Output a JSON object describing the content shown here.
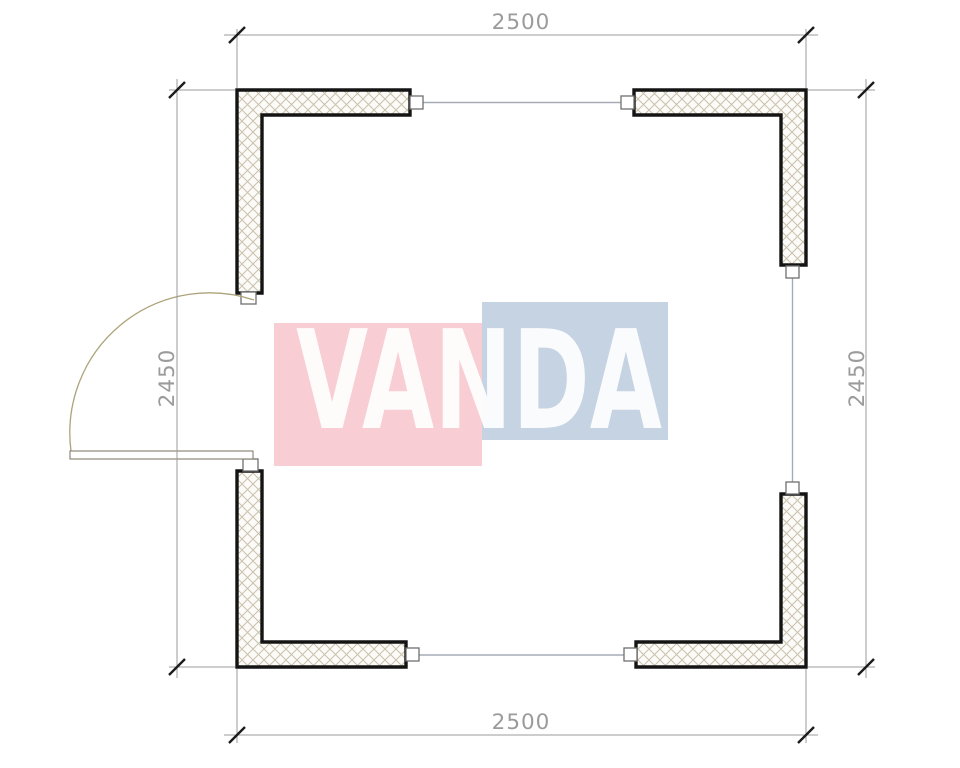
{
  "drawing": {
    "type": "floor-plan",
    "dimensions": {
      "top": "2500",
      "bottom": "2500",
      "left": "2450",
      "right": "2450"
    },
    "watermark": {
      "text": "VANDA"
    },
    "colors": {
      "wall": "#141414",
      "hatch-line": "#c8c1ad",
      "hatch-bg": "#fcfbf8",
      "dim-line": "#9b9b9b",
      "tick": "#1c1c1c",
      "dim-text": "#9b9b9b",
      "window-line": "#a5abb6",
      "marker": "#6f6f6f",
      "door": "#ada379",
      "leaf": "#857f6d",
      "wm-pink": "#f8cdd4",
      "wm-blue": "#c5d3e3",
      "wm-text": "#ffffff"
    }
  }
}
